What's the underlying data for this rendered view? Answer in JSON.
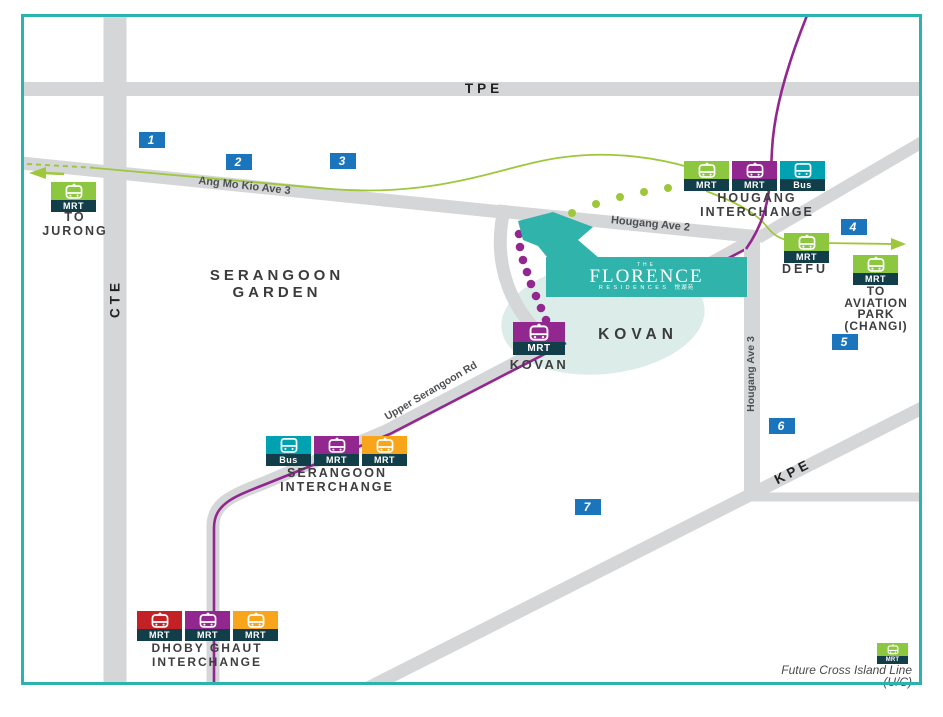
{
  "colors": {
    "border_teal": "#2BB3AF",
    "road_gray": "#D5D6D8",
    "line_purple": "#92278F",
    "line_lime": "#9FC73C",
    "icon_green": "#8DC63F",
    "icon_purple": "#92278F",
    "icon_teal": "#00A1B0",
    "icon_orange": "#F9A51C",
    "icon_red": "#C42127",
    "icon_band_dark": "#123E49",
    "marker_blue": "#1B75BC",
    "brand_teal": "#2FB3AB",
    "kovan_blob": "#DBECE9"
  },
  "badges": {
    "mrt": "MRT",
    "bus": "Bus"
  },
  "markers": {
    "m1": "1",
    "m2": "2",
    "m3": "3",
    "m4": "4",
    "m5": "5",
    "m6": "6",
    "m7": "7"
  },
  "expressways": {
    "tpe": "TPE",
    "cte": "CTE",
    "kpe": "KPE"
  },
  "roads": {
    "ang_mo_kio": "Ang Mo Kio Ave 3",
    "hougang_ave_2": "Hougang Ave 2",
    "hougang_ave_3": "Hougang Ave 3",
    "upper_serangoon": "Upper Serangoon Rd"
  },
  "areas": {
    "serangoon_garden_line1": "SERANGOON",
    "serangoon_garden_line2": "GARDEN",
    "kovan": "KOVAN"
  },
  "stations": {
    "jurong": {
      "line1": "TO",
      "line2": "JURONG"
    },
    "hougang": {
      "line1": "HOUGANG",
      "line2": "INTERCHANGE"
    },
    "defu": {
      "label": "DEFU"
    },
    "aviation": {
      "line1": "TO",
      "line2": "AVIATION",
      "line3": "PARK",
      "line4": "(CHANGI)"
    },
    "kovan": {
      "label": "KOVAN"
    },
    "serangoon": {
      "line1": "SERANGOON",
      "line2": "INTERCHANGE"
    },
    "dhoby_ghaut": {
      "line1": "DHOBY GHAUT",
      "line2": "INTERCHANGE"
    },
    "future_cil": {
      "line1": "Future Cross Island Line",
      "line2": "(U/C)"
    }
  },
  "logo": {
    "the": "THE",
    "name": "FLORENCE",
    "residences": "RESIDENCES",
    "chinese": "悦湖苑"
  }
}
